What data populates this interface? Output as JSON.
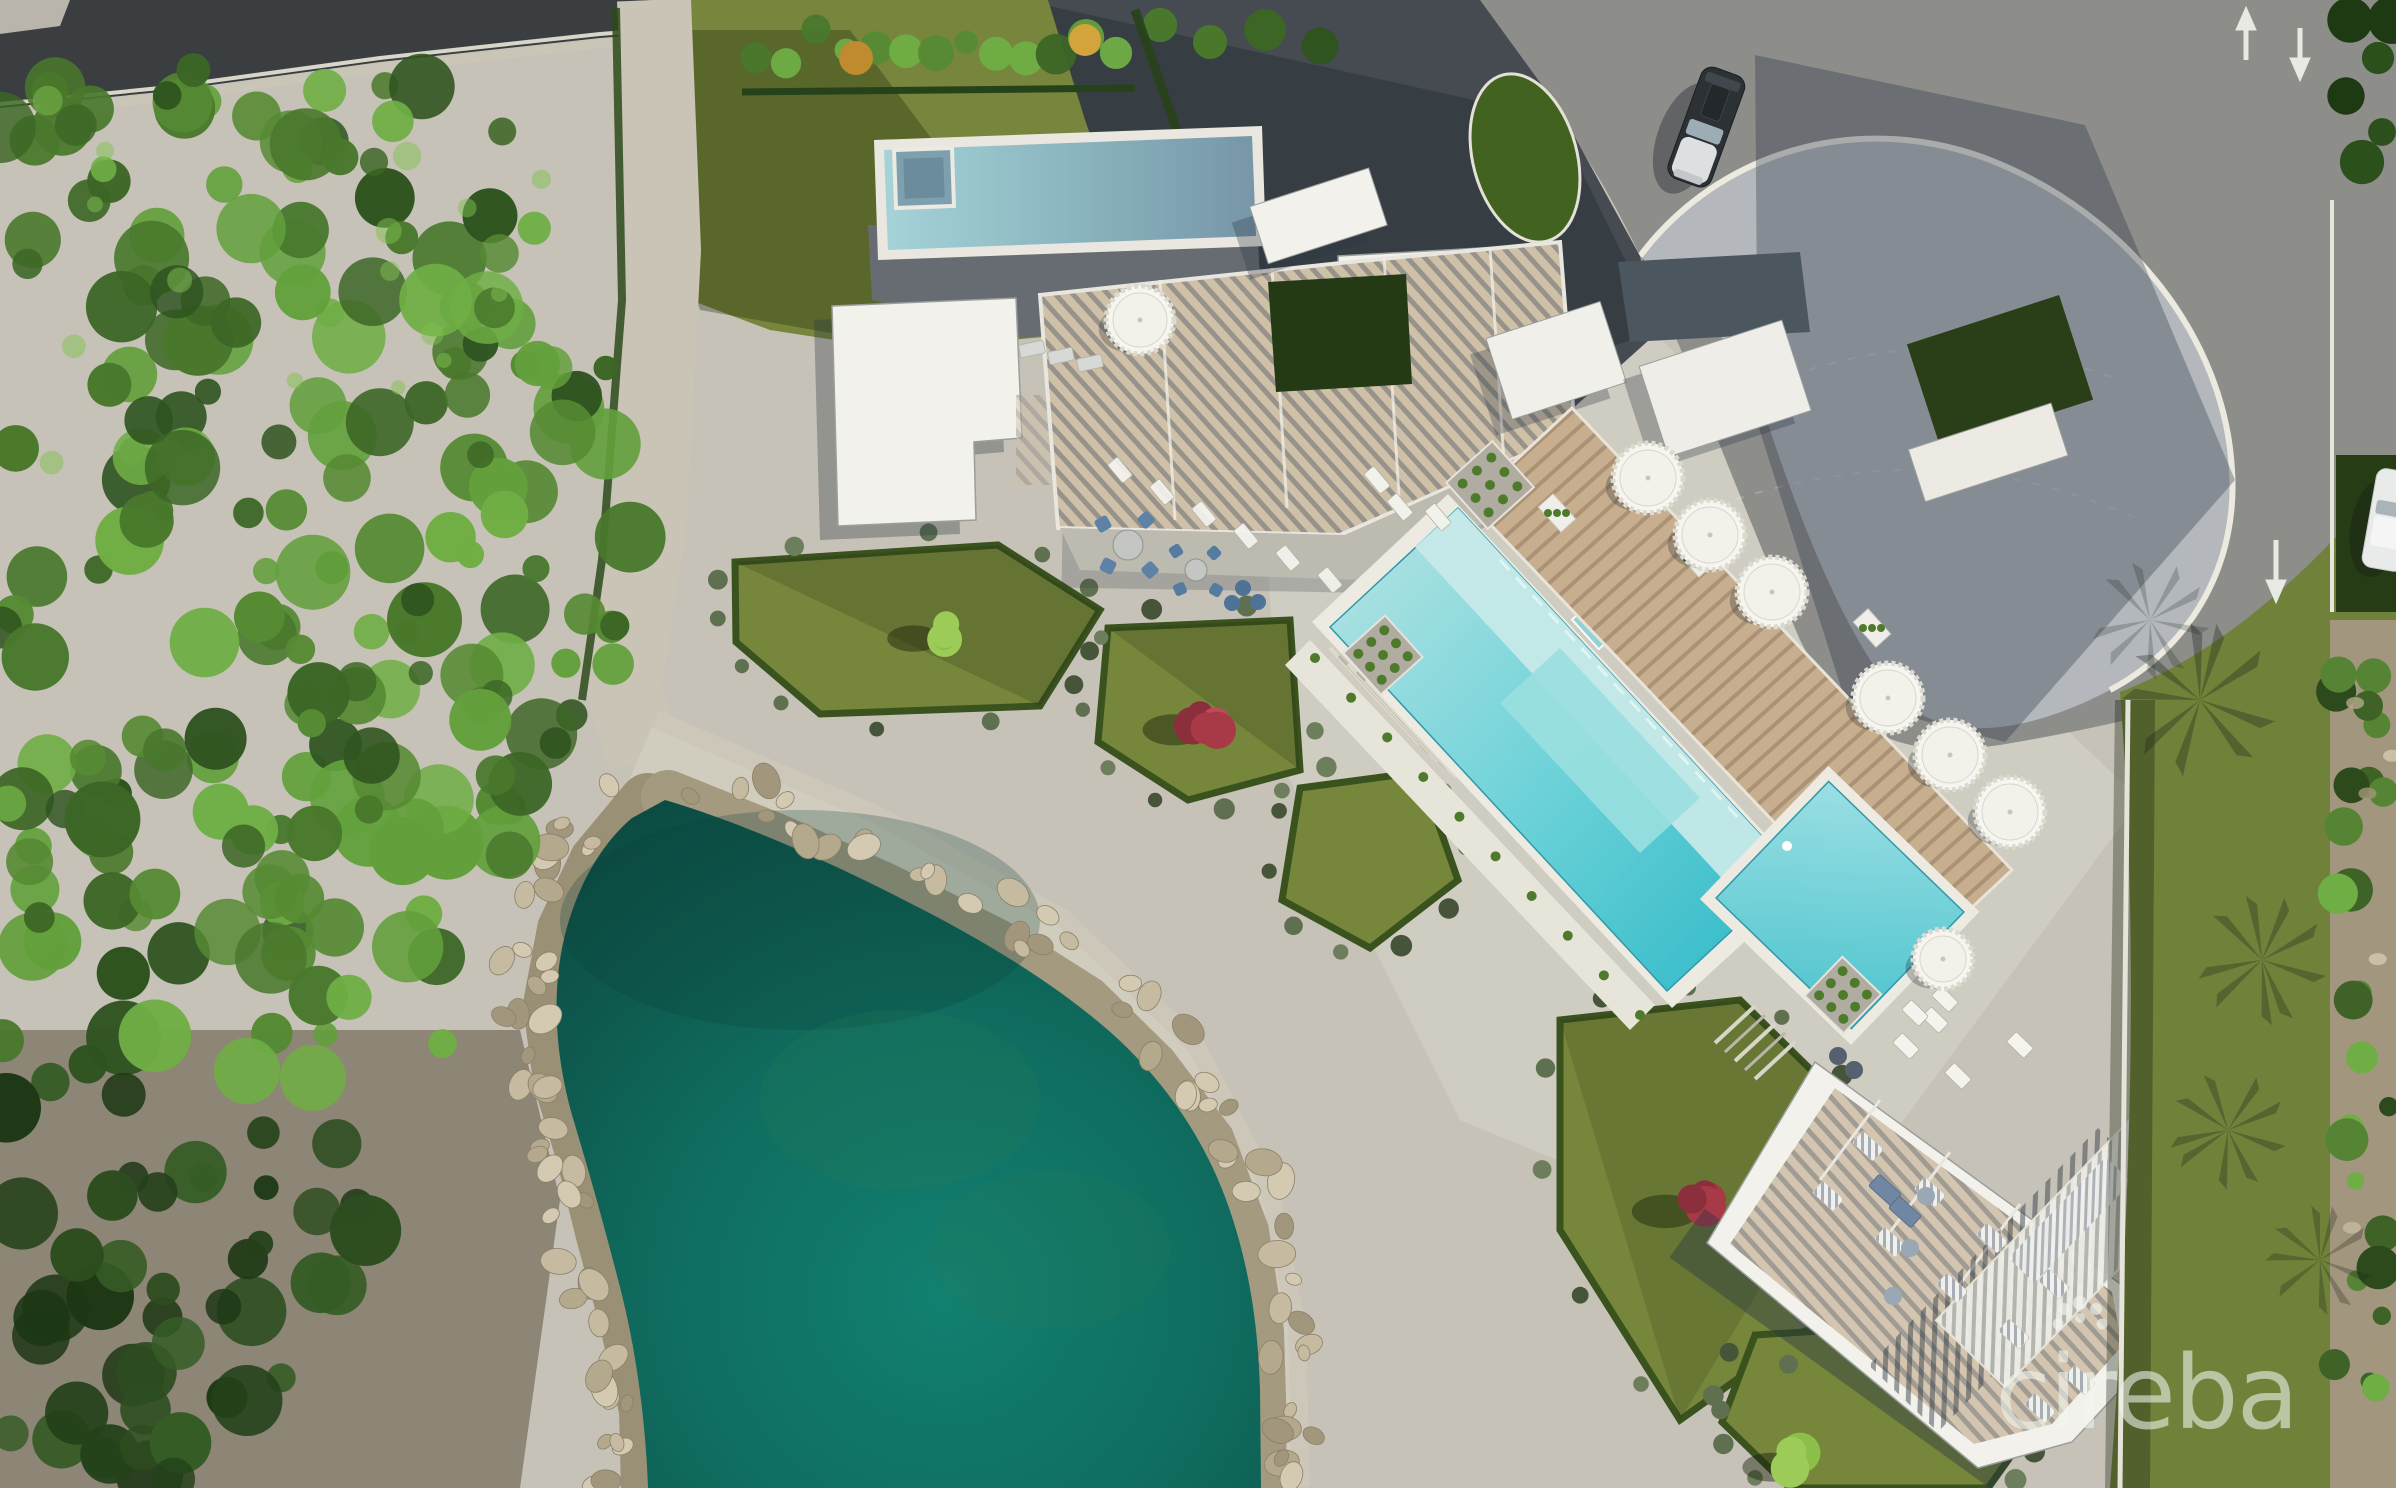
{
  "watermark": {
    "text": "cireba",
    "icon": "flower-dots-icon",
    "color": "rgba(242,246,240,0.58)"
  },
  "palette": {
    "plaza": "#c6c2b7",
    "plaza_light": "#d3d0c5",
    "walkway": "#ccc7b8",
    "road_asphalt": "#8d8d8a",
    "driveway_dark": "#454b51",
    "road_top_left": "#3b3e41",
    "apron_pavers": "#b4b8bd",
    "lagoon_deep": "#0c4a41",
    "lagoon_bright": "#128070",
    "pool_pale": "#c6e9e8",
    "pool_deep": "#2cb8c6",
    "villa_pool_shadow": "#7796a8",
    "deck_wood": "#c7ae8f",
    "roof_white": "#f2f1eb",
    "roof_slate": "#4b565f",
    "roof_garden_green": "#2a3f17",
    "louver_slat": "#cfc0a8",
    "lawn_olive": "#77863c",
    "garden_lawn": "#76863b",
    "hedge_dark": "#3a521e",
    "forest_greens": [
      "#3c6625",
      "#49782c",
      "#568a33",
      "#63a03c",
      "#2f5420",
      "#6fae45"
    ],
    "forest_dark": [
      "#24411a",
      "#2d4d1f",
      "#1d3714",
      "#365c26"
    ],
    "rock_colors": [
      "#d4cab2",
      "#c6bba1",
      "#b4a88d",
      "#a2967c"
    ],
    "shrub_colors": [
      "#5f7050",
      "#46543a",
      "#6d7e5c"
    ],
    "bush_red": [
      "#a83a48",
      "#c04b59",
      "#8c2f3c"
    ],
    "bush_green": [
      "#8cbf4a",
      "#9ccb58"
    ],
    "furniture_blue": "#5d82a6",
    "umbrella_white": "#f6f5ef",
    "car_dark": "#2c3135",
    "car_white": "#e9eaea"
  }
}
